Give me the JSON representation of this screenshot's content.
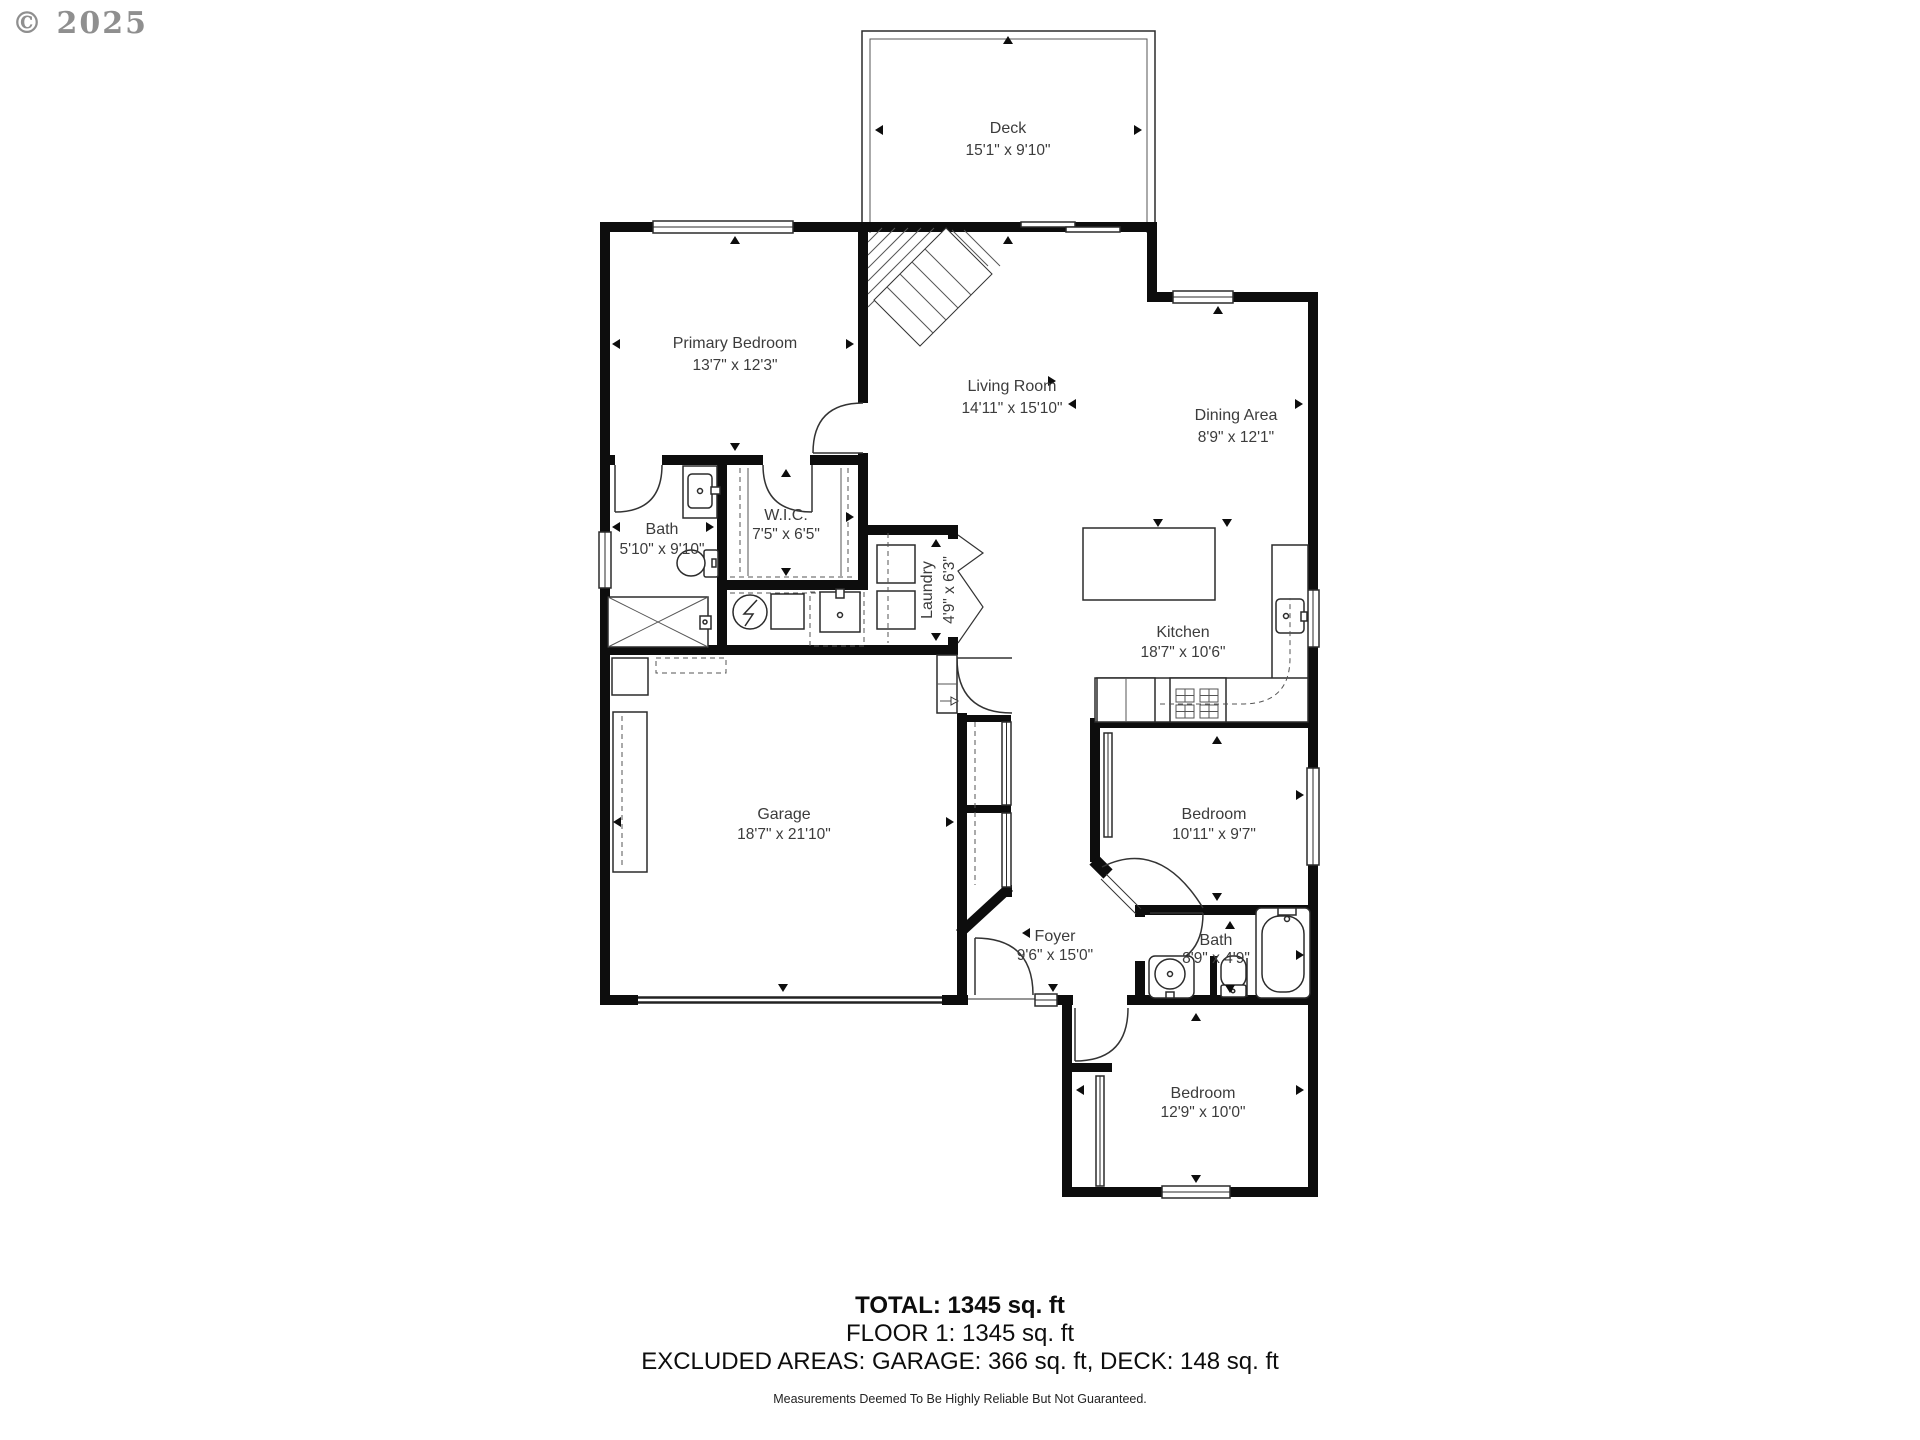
{
  "watermark": "© 2025",
  "plan": {
    "rooms": [
      {
        "id": "deck",
        "name": "Deck",
        "dims": "15'1\" x 9'10\""
      },
      {
        "id": "primary-bedroom",
        "name": "Primary Bedroom",
        "dims": "13'7\" x 12'3\""
      },
      {
        "id": "living-room",
        "name": "Living Room",
        "dims": "14'11\" x 15'10\""
      },
      {
        "id": "dining-area",
        "name": "Dining Area",
        "dims": "8'9\" x 12'1\""
      },
      {
        "id": "bath-primary",
        "name": "Bath",
        "dims": "5'10\" x 9'10\""
      },
      {
        "id": "walk-in-closet",
        "name": "W.I.C.",
        "dims": "7'5\" x 6'5\""
      },
      {
        "id": "laundry",
        "name": "Laundry",
        "dims": "4'9\" x 6'3\""
      },
      {
        "id": "kitchen",
        "name": "Kitchen",
        "dims": "18'7\" x 10'6\""
      },
      {
        "id": "garage",
        "name": "Garage",
        "dims": "18'7\" x 21'10\""
      },
      {
        "id": "bedroom-1",
        "name": "Bedroom",
        "dims": "10'11\" x 9'7\""
      },
      {
        "id": "foyer",
        "name": "Foyer",
        "dims": "9'6\" x 15'0\""
      },
      {
        "id": "bath-hall",
        "name": "Bath",
        "dims": "8'9\" x 4'9\""
      },
      {
        "id": "bedroom-2",
        "name": "Bedroom",
        "dims": "12'9\" x 10'0\""
      }
    ]
  },
  "summary": {
    "total": "TOTAL: 1345 sq. ft",
    "floor1": "FLOOR 1: 1345 sq. ft",
    "excluded": "EXCLUDED AREAS: GARAGE: 366 sq. ft, DECK: 148 sq. ft",
    "disclaimer": "Measurements Deemed To Be Highly Reliable But Not Guaranteed."
  },
  "colors": {
    "wall": "#0d0d0d",
    "label": "#3c3c3c",
    "watermark": "#8f8f8f"
  }
}
